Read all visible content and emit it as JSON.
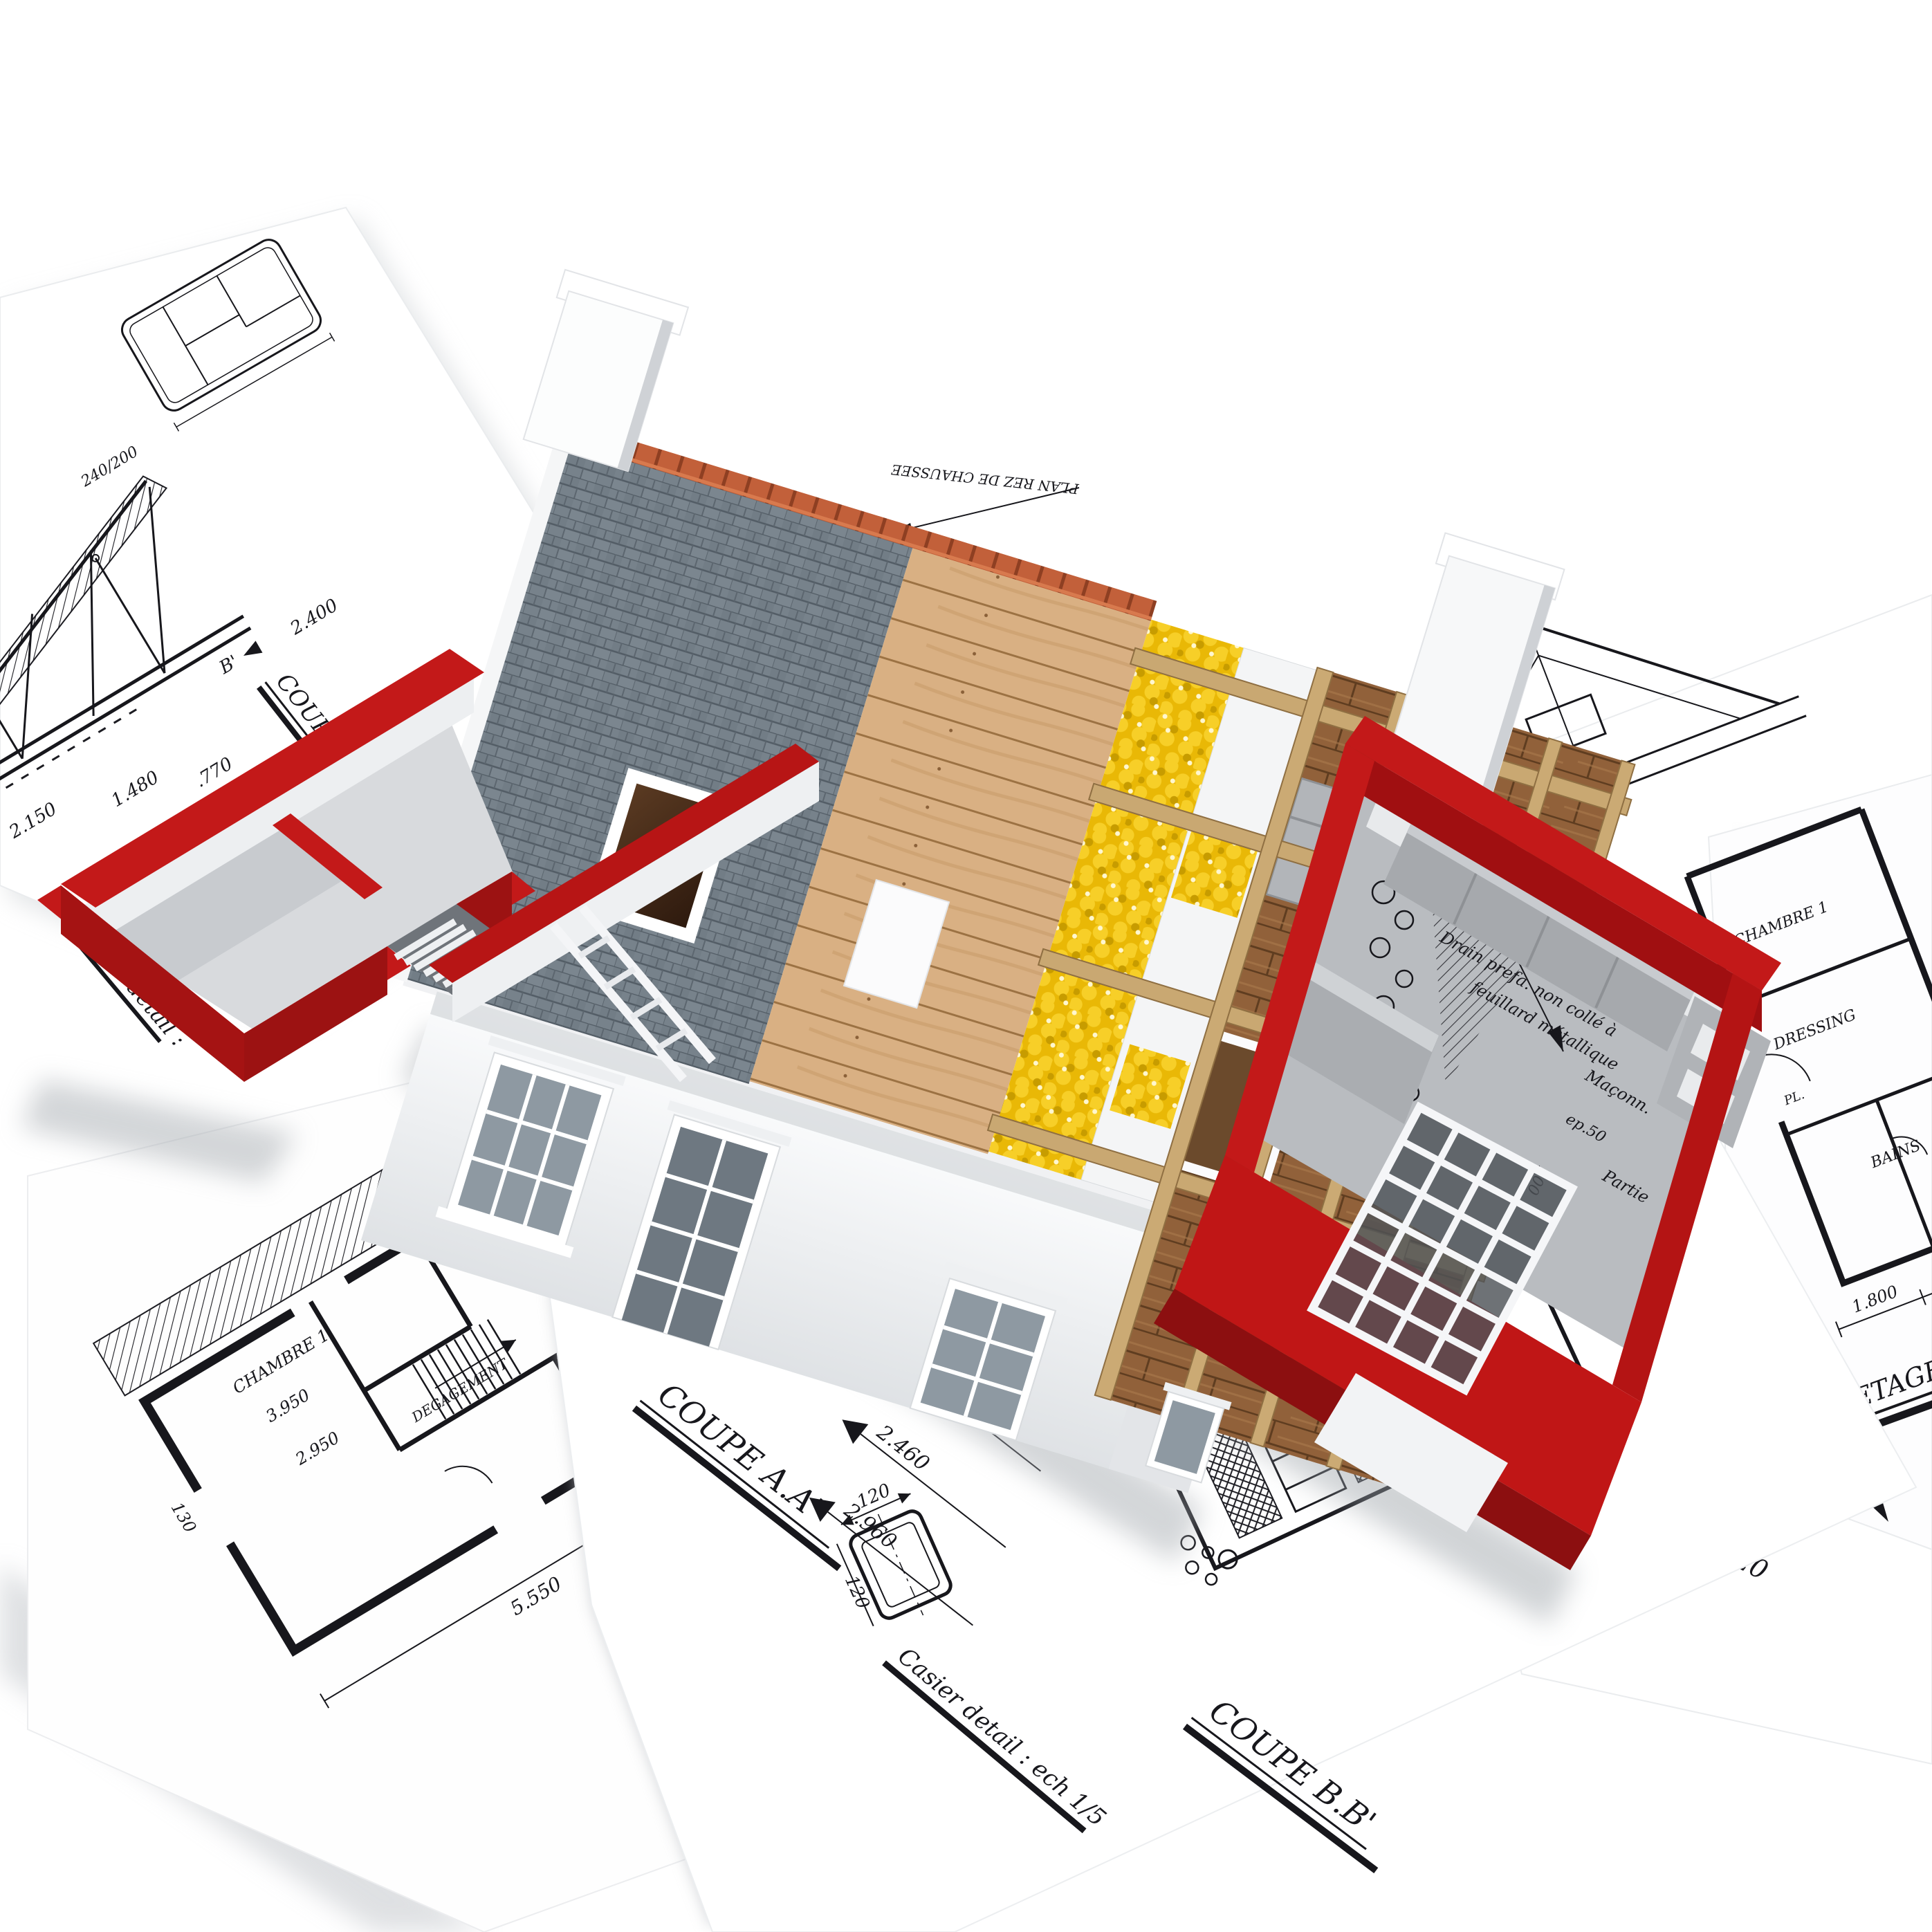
{
  "labels": {
    "coupe_aa": "COUPE A.A'",
    "coupe_bb": "COUPE B.B'",
    "coupe_cc": "COUPE C.C'",
    "detail_c": "DETAIL C.",
    "echelle": "echelle 1/20",
    "casier": "Casier detail : ech 1/5",
    "cadre": "Cadre detail :",
    "etage": "1er ETAGE.",
    "plan_rdc": "PLAN REZ DE CHAUSSEE",
    "marker_b": "B'"
  },
  "dims": {
    "levels": [
      "2.350",
      "2.460",
      "2.960"
    ],
    "casier": [
      "120",
      "120"
    ],
    "etage": [
      "1.800",
      "3.600",
      "850"
    ],
    "floorplan": [
      "5.550",
      "920",
      "2.470",
      "3.950",
      "2.950",
      "4.140",
      "130"
    ],
    "topleft": [
      "2.150",
      "1.480",
      ".770",
      "2.400",
      "240/200"
    ]
  },
  "rooms": {
    "floorplan": [
      "CHAMBRE 1",
      "CHAMBRE 3",
      "DEGAGEMENT"
    ],
    "etage": [
      "CHAMBRE 1",
      "DRESSING",
      "BAINS",
      "PL."
    ]
  },
  "notes": {
    "kitchen": [
      "Remblai croissant : de la terre",
      "Drain prefa. non collé à",
      "feuillard métallique",
      "Maçonn.",
      "ep.50",
      "200",
      "Partie"
    ]
  },
  "colors": {
    "red_wall": "#c31919",
    "red_dark": "#9c1212",
    "slate": "#77828b",
    "sheathing": "#d9b083",
    "insulation": "#e9b806",
    "rafter": "#c9a872",
    "floor_planks": "#91613a",
    "ridge_tile": "#c2603a",
    "ink": "#17171c",
    "paper": "#ffffff"
  }
}
